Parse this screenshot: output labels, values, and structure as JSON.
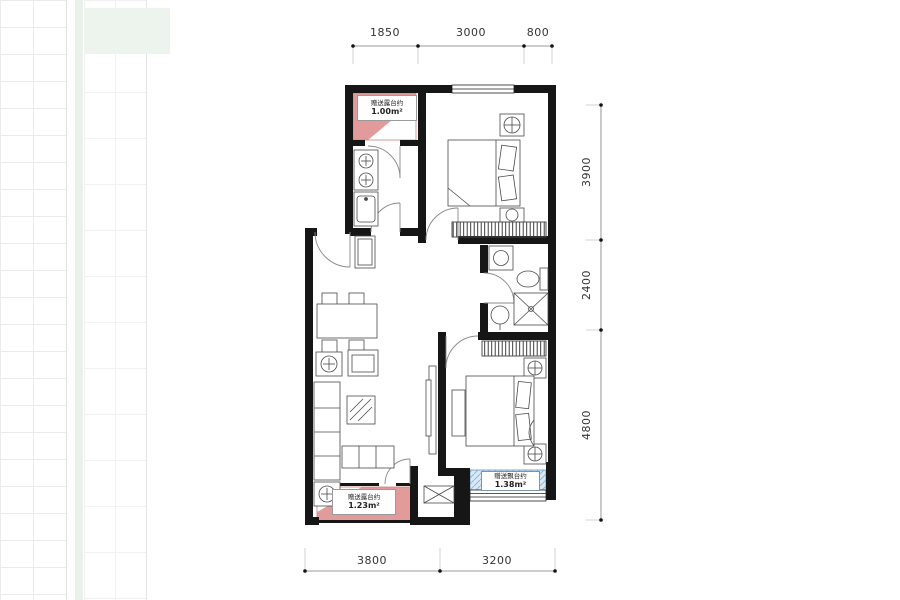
{
  "dimensions": {
    "top": [
      "1850",
      "3000",
      "800"
    ],
    "right": [
      "3900",
      "2400",
      "4800"
    ],
    "bottom": [
      "3800",
      "3200"
    ]
  },
  "areas": {
    "balcony_top": {
      "name": "赠送露台约",
      "value": "1.00m²"
    },
    "balcony_bottom": {
      "name": "赠送露台约",
      "value": "1.23m²"
    },
    "bay_window": {
      "name": "赠送飘台约",
      "value": "1.38m²"
    }
  },
  "colors": {
    "wall": "#161616",
    "balcony_fill": "#e29b9b",
    "balcony_edge": "#c97f7f",
    "bay_fill": "#d9e8f6",
    "bay_hatch": "#8fb8dc",
    "furniture_line": "#4a4a4a",
    "dimension_line": "#7a7a7a"
  }
}
